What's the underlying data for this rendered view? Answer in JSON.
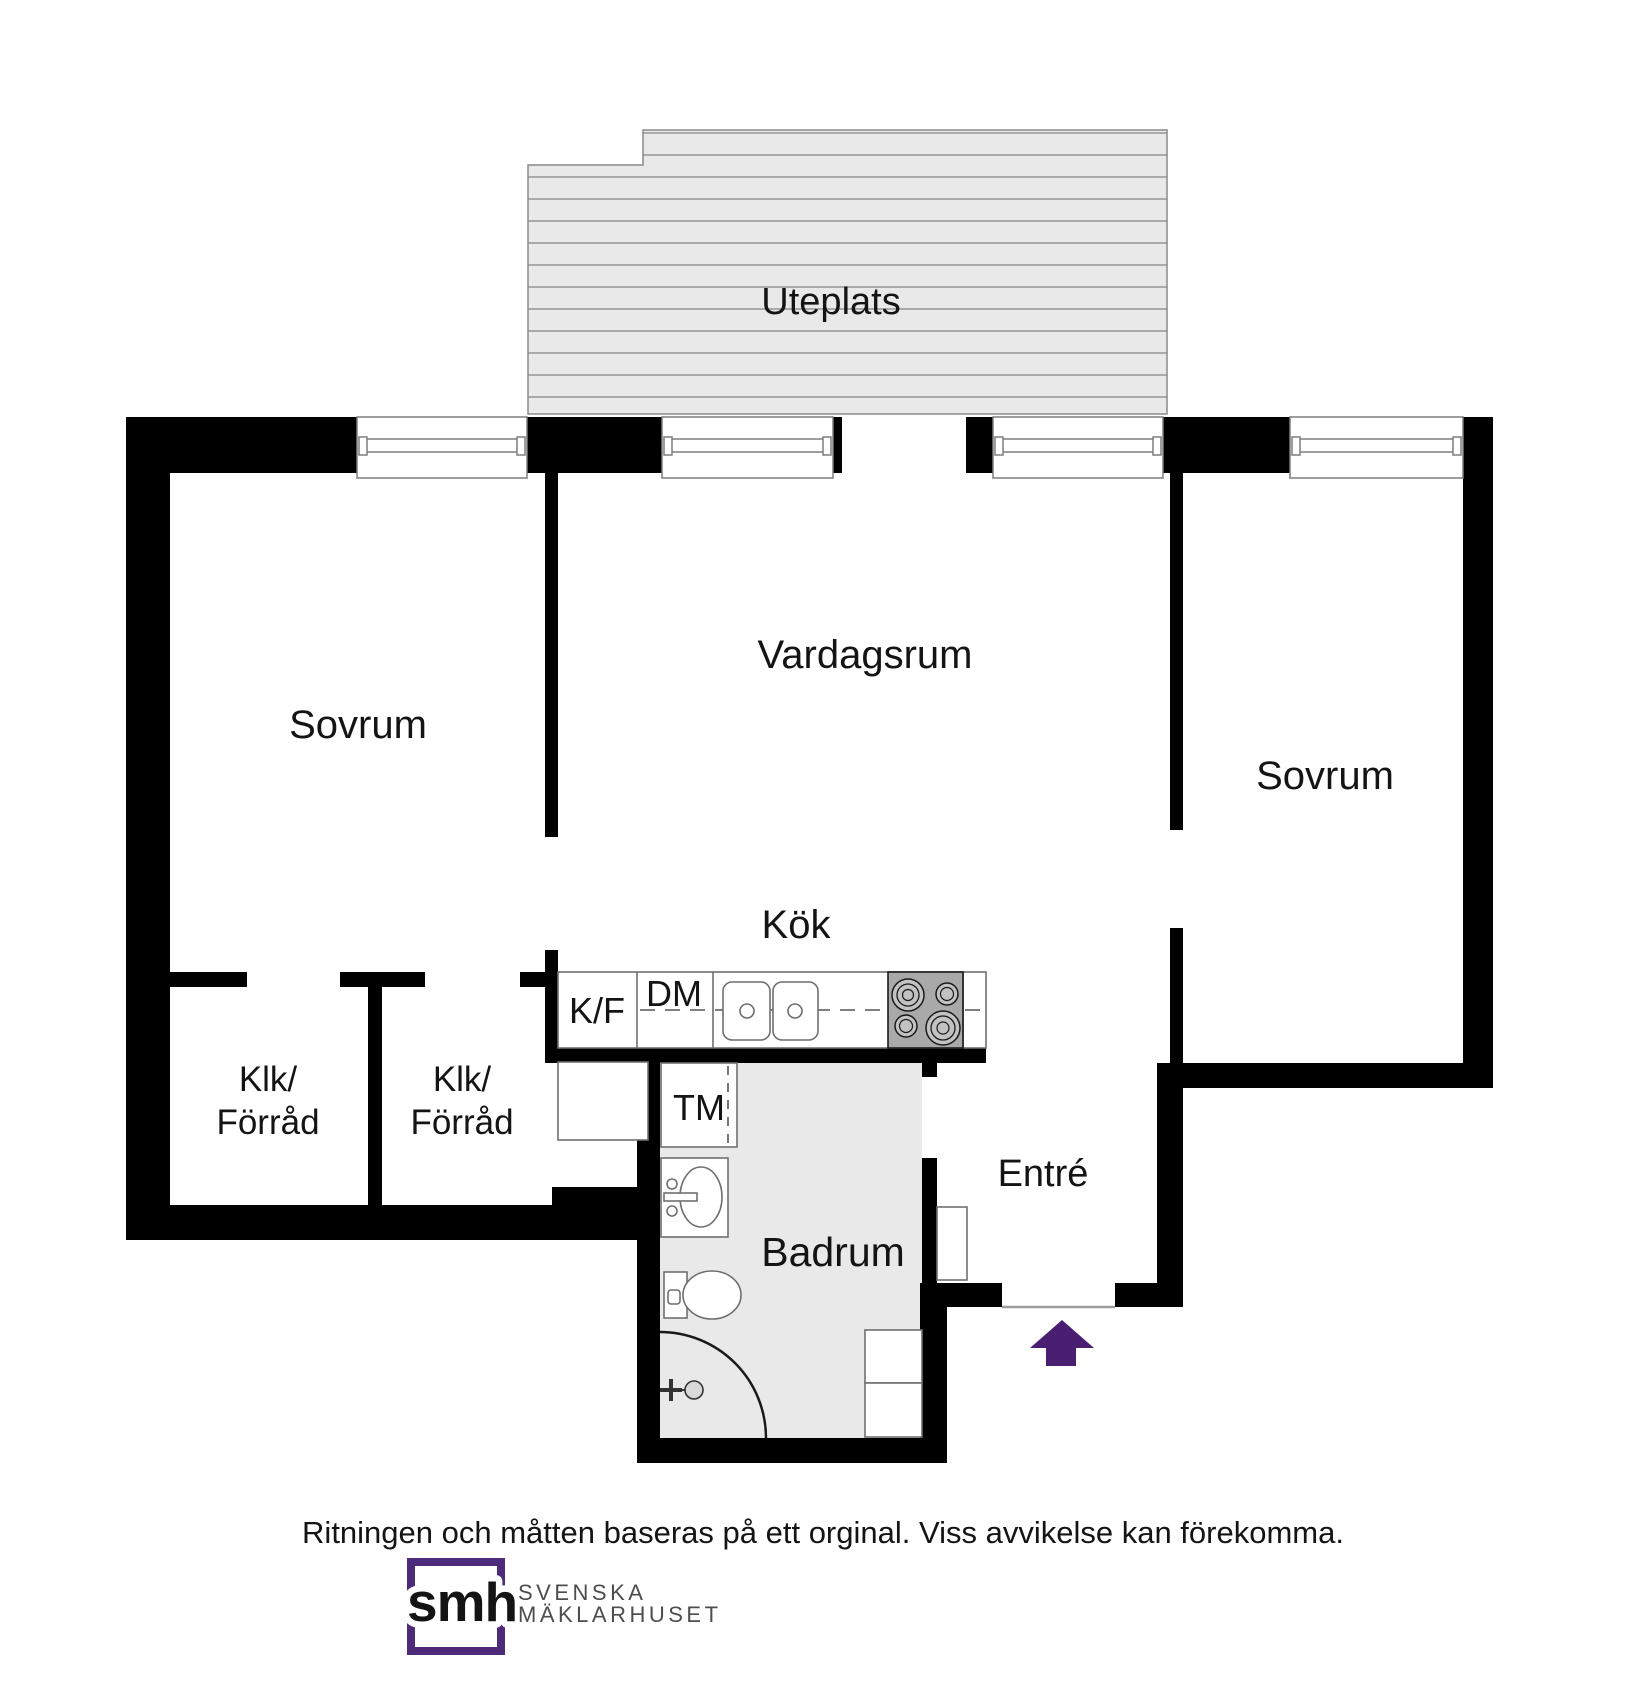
{
  "rooms": {
    "uteplats": {
      "label": "Uteplats"
    },
    "sovrum_left": {
      "label": "Sovrum"
    },
    "vardagsrum": {
      "label": "Vardagsrum"
    },
    "sovrum_right": {
      "label": "Sovrum"
    },
    "kok": {
      "label": "Kök"
    },
    "klk_left": {
      "line1": "Klk/",
      "line2": "Förråd"
    },
    "klk_right": {
      "line1": "Klk/",
      "line2": "Förråd"
    },
    "badrum": {
      "label": "Badrum"
    },
    "entre": {
      "label": "Entré"
    }
  },
  "appliances": {
    "fridge_freezer": "K/F",
    "dishwasher": "DM",
    "washing_machine": "TM"
  },
  "icons": {
    "entrance_arrow": "up-block-arrow",
    "stove": "four-burner-cooktop",
    "kitchen_sink": "double-basin-sink",
    "bathroom_sink": "washbasin",
    "toilet": "toilet",
    "shower": "corner-shower-arc",
    "window": "double-line-window"
  },
  "footer": {
    "disclaimer": "Ritningen och måtten baseras på ett orginal. Viss avvikelse kan förekomma."
  },
  "logo": {
    "mark": "smh",
    "name_line1": "SVENSKA",
    "name_line2": "MÄKLARHUSET"
  },
  "colors": {
    "wall": "#000000",
    "floor_gray": "#e9e9e9",
    "stripe_line": "#9b9b9b",
    "fixture_stroke": "#6f6f6f",
    "arrow_purple": "#4a1e70",
    "brand_purple": "#4e2a7a",
    "text": "#141414"
  }
}
